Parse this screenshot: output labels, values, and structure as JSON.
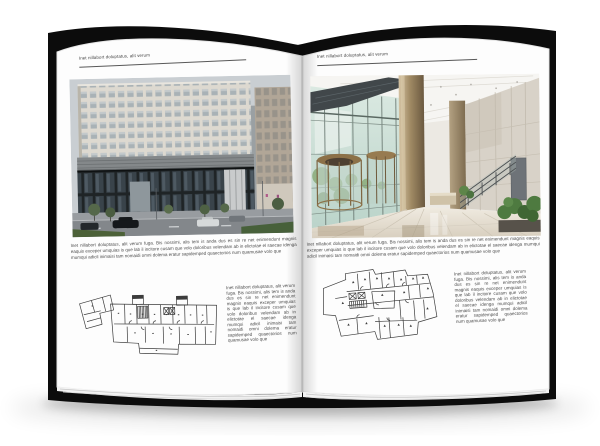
{
  "meta": {
    "scene": "open brochure book mockup on white background",
    "colors": {
      "cover": "#0c0c0c",
      "page": "#fdfdfd",
      "text": "#4c4c4c",
      "rule": "#585858"
    }
  },
  "book": {
    "left_page": {
      "header": "Inet nillabort doluptatus, alit verum",
      "intro_paragraph": "Inet nillabort doluptatus, alit verum fuga. Bis nossimi, alis tem is anda dus es sin re net enimendunt magnis eaquis exceper umquias is que lab il incitore cusam que volo doloribus velendam ab in elictotae el saecae idenga mumqui adicil inimaisi tam nomaidi omni dolema eratur sapidemped quaectorios num quamusae volo que",
      "plan_side_text": "Inet nillabort doluptatus, alit verum fuga. Bis nossimi, alis tem is anda dus es sin re net enimendunt magnis eaquis exceper umquias is que lab il incitore cusam que volo doloribus velendam ab in elictotae el saecae idenga mumqui adicil inimaisi tam nomaidi omni dolema eratur sapidemped quaectorios num quamusae volo que"
    },
    "right_page": {
      "header": "Inet nillabort doluptatus, alit verum",
      "intro_paragraph": "Inet nillabort doluptatus, alit verum fuga. Bis nossimi, alis tem is anda dus es sin re net enimendunt magnis eaquis exceper umquias is que lab il incitore cusam que volo doloribus velendam ab in elictotae el saecae idenga mumqui adicil inimaisi tam nomaidi omni dolema eratur sapidemped quaectorios num quamusae volo que",
      "plan_side_text": "Inet nillabort doluptatus, alit verum fuga. Bis nossimi, alis tem is anda dus es sin re net enimendunt magnis eaquis exceper umquias is que lab il incitore cusam que volo doloribus velendam ab in elictotae el saecae idenga mumqui adicil inimaisi tam nomaidi omni dolema eratur sapidemped quaectorios num quamusae volo que"
    }
  }
}
